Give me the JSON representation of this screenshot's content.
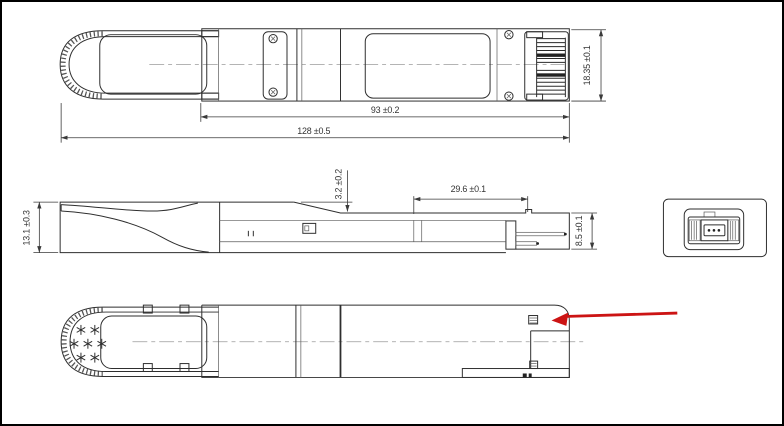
{
  "figure": {
    "kind": "mechanical-dimension-drawing",
    "views": [
      "top-view",
      "side-view",
      "end-view",
      "bottom-view"
    ]
  },
  "dims": {
    "body_length": "93 ±0.2",
    "overall_length": "128 ±0.5",
    "module_width": "18.35 ±0.1",
    "handle_step": "3.2 ±0.2",
    "nose_length": "29.6 ±0.1",
    "module_height": "13.1 ±0.3",
    "nose_height": "8.5 ±0.1"
  },
  "colors": {
    "background": "#ffffff",
    "frame": "#000000",
    "line": "#2e2e2e",
    "centerline": "#9b9b9b",
    "callout_arrow": "#cc1414"
  }
}
